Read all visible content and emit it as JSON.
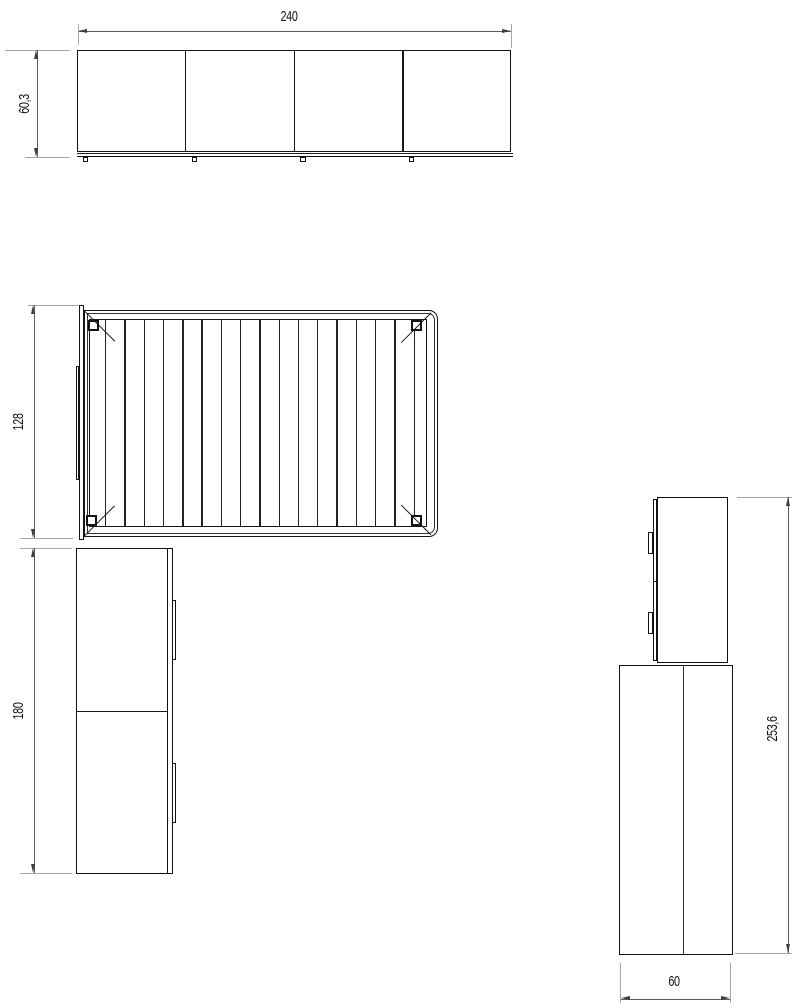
{
  "colors": {
    "background": "#ffffff",
    "line": "#1a1a1a",
    "dimension_line": "#5a5a5a",
    "extension_line": "#a8a8a8",
    "text": "#111111"
  },
  "views": {
    "front_elevation": {
      "width_label": "240",
      "height_label": "60,3",
      "door_panels": 4,
      "feet": 4
    },
    "plan": {
      "depth_label": "128",
      "slat_lines": 17,
      "corner_brackets": 4
    },
    "cabinet_front": {
      "height_label": "180",
      "door_sections": 2,
      "handles": 2
    },
    "side_elevation": {
      "height_label": "253,6",
      "depth_label": "60",
      "handles": 2
    }
  }
}
